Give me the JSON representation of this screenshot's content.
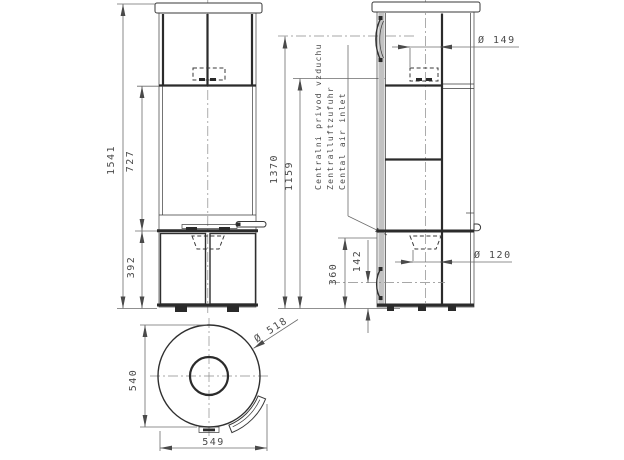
{
  "front_view": {
    "height_total": "1541",
    "height_upper": "727",
    "height_lower": "392"
  },
  "side_view": {
    "height_handle": "1370",
    "height_flue": "1159",
    "flue_diameter": "Ø 149",
    "inlet_diameter": "Ø 120",
    "inlet_top_height": "360",
    "inlet_center_height": "142",
    "air_inlet_label_cz": "Centralni privod vzduchu",
    "air_inlet_label_de": "Zentralluftzufuhr",
    "air_inlet_label_en": "Cental air inlet"
  },
  "top_view": {
    "body_diameter": "Ø 518",
    "depth": "540",
    "width": "549"
  }
}
